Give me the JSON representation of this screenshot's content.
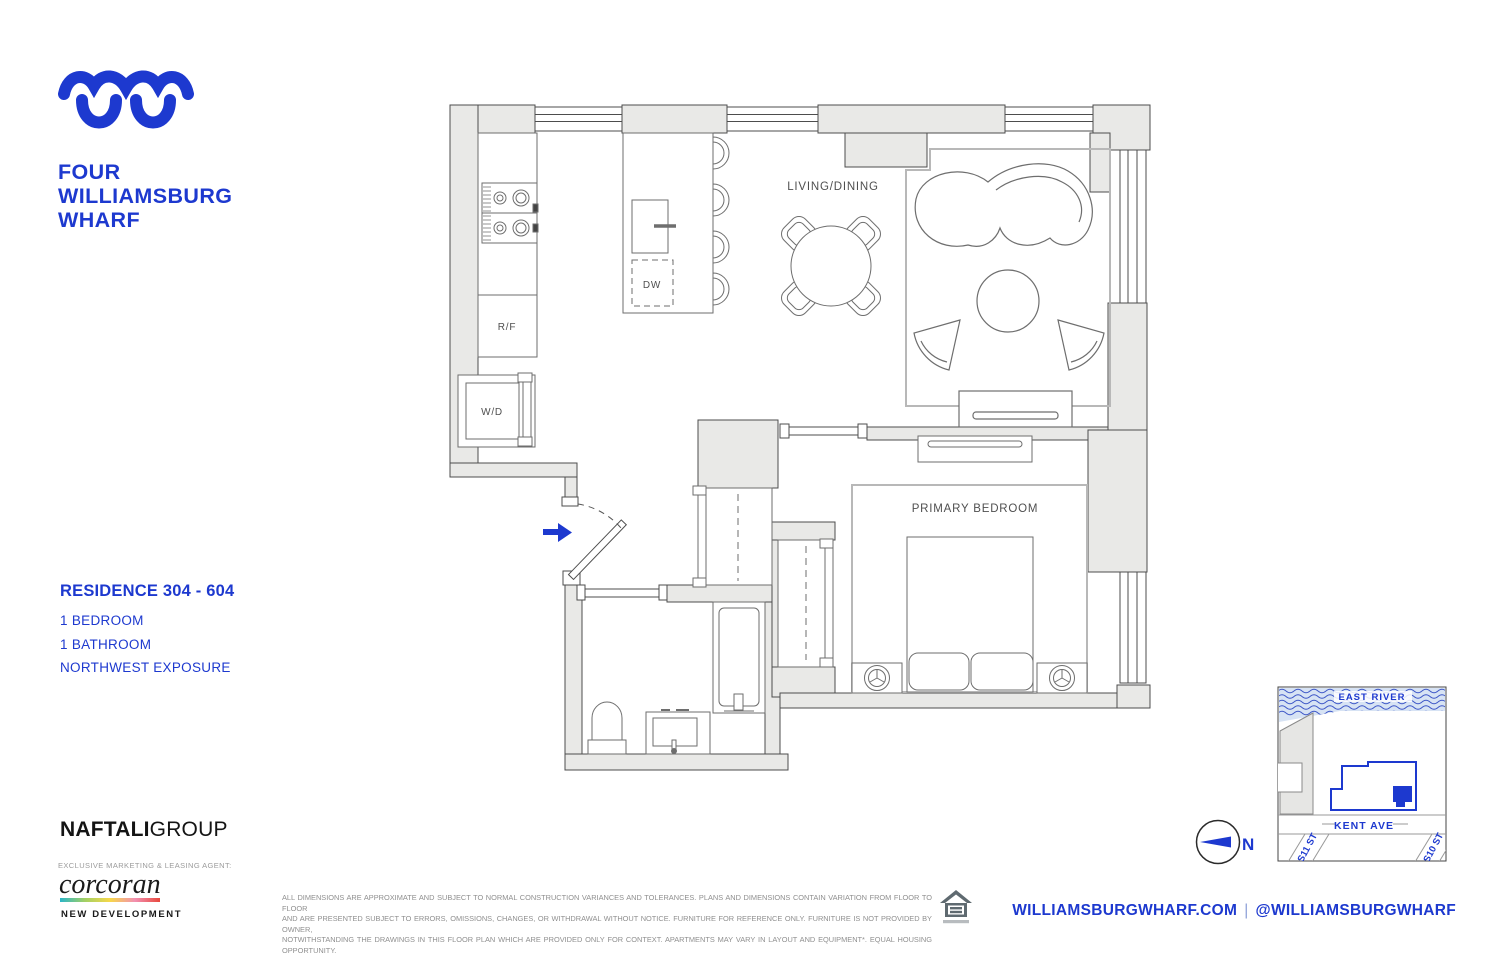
{
  "colors": {
    "brand_blue": "#1d39cf",
    "wall_gray": "#e9e9e7",
    "wall_line": "#4d4d4d",
    "furniture_line": "#6e6e6e",
    "label_gray": "#4f4f4f",
    "rug_gray": "#b8b8b8",
    "water_blue": "#d7e3f4",
    "corcoran_bar_gradient": [
      "#2ab5c8",
      "#a3d064",
      "#f7d84a",
      "#f290b1",
      "#e8483d"
    ]
  },
  "brand": {
    "name_line1": "FOUR",
    "name_line2": "WILLIAMSBURG",
    "name_line3": "WHARF"
  },
  "residence": {
    "title": "RESIDENCE 304 - 604",
    "features": [
      "1 BEDROOM",
      "1 BATHROOM",
      "NORTHWEST EXPOSURE"
    ]
  },
  "plan": {
    "living_dining": "LIVING/DINING",
    "primary_bedroom": "PRIMARY BEDROOM",
    "refrigerator": "R/F",
    "washer_dryer": "W/D",
    "dishwasher": "DW"
  },
  "site_map": {
    "river": "EAST RIVER",
    "avenue": "KENT AVE",
    "street_left": "S11 ST",
    "street_right": "S10 ST",
    "compass_north": "N"
  },
  "marketing": {
    "developer_primary": "NAFTALI",
    "developer_secondary": "GROUP",
    "agent_heading": "EXCLUSIVE MARKETING & LEASING AGENT:",
    "agent_name": "corcoran",
    "agent_division": "NEW DEVELOPMENT"
  },
  "footer": {
    "disclaimer_lines": [
      "ALL DIMENSIONS ARE APPROXIMATE AND SUBJECT TO NORMAL CONSTRUCTION VARIANCES AND TOLERANCES. PLANS AND DIMENSIONS CONTAIN VARIATION FROM FLOOR TO FLOOR",
      "AND ARE PRESENTED SUBJECT TO ERRORS, OMISSIONS, CHANGES, OR WITHDRAWAL WITHOUT NOTICE. FURNITURE FOR REFERENCE ONLY. FURNITURE IS NOT PROVIDED BY OWNER,",
      "NOTWITHSTANDING THE DRAWINGS IN THIS FLOOR PLAN WHICH ARE PROVIDED ONLY FOR CONTEXT.  APARTMENTS MAY VARY IN LAYOUT AND EQUIPMENT*. EQUAL HOUSING OPPORTUNITY."
    ],
    "website": "WILLIAMSBURGWHARF.COM",
    "divider": "|",
    "social": "@WILLIAMSBURGWHARF"
  }
}
